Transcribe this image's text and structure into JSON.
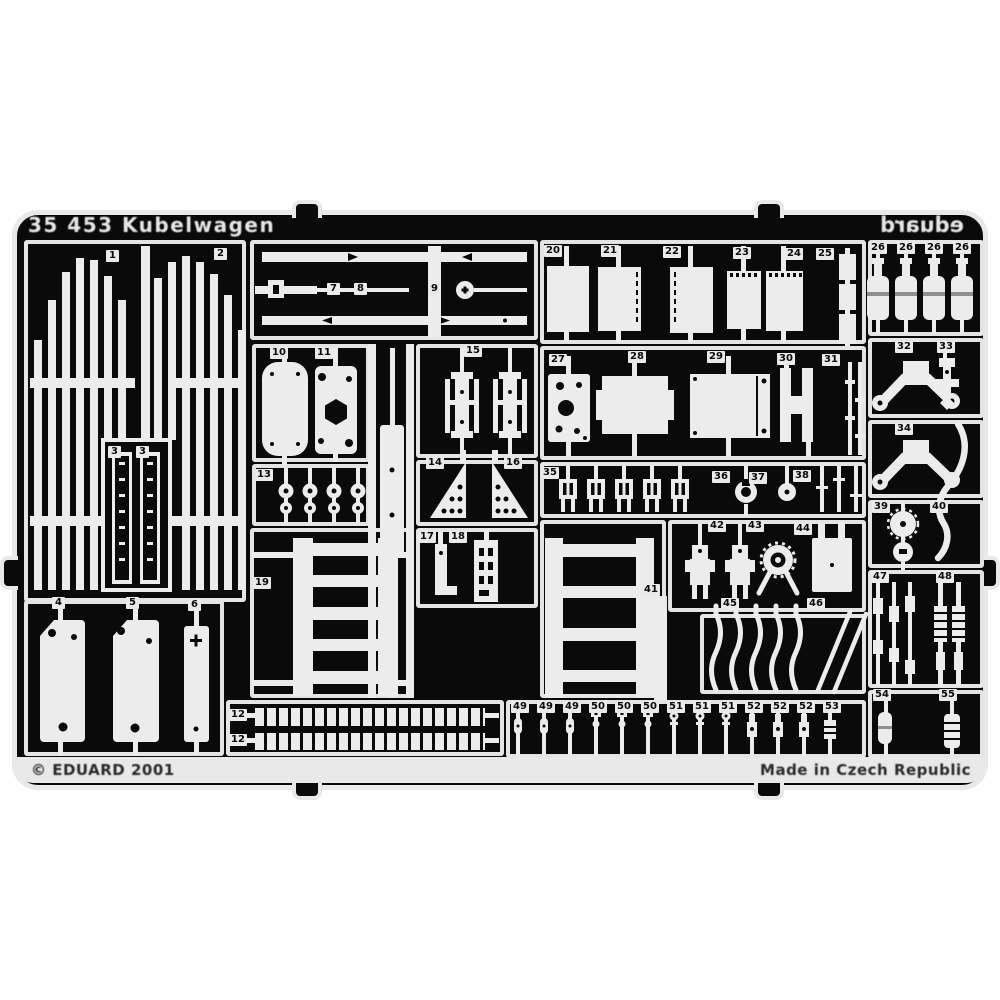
{
  "page": {
    "background": "#ffffff"
  },
  "fret": {
    "plate_color": "#0a0a0a",
    "metal_color": "#ececec",
    "set_title": "35 453 Kubelwagen",
    "brand_mirrored": "eduard",
    "copyright": "© EDUARD 2001",
    "made_in": "Made in Czech Republic",
    "part_labels": [
      {
        "n": "1",
        "x": 106,
        "y": 250
      },
      {
        "n": "2",
        "x": 214,
        "y": 248
      },
      {
        "n": "3",
        "x": 108,
        "y": 446
      },
      {
        "n": "3",
        "x": 136,
        "y": 446
      },
      {
        "n": "4",
        "x": 52,
        "y": 597
      },
      {
        "n": "5",
        "x": 126,
        "y": 597
      },
      {
        "n": "6",
        "x": 188,
        "y": 599
      },
      {
        "n": "7",
        "x": 327,
        "y": 283
      },
      {
        "n": "8",
        "x": 354,
        "y": 283
      },
      {
        "n": "9",
        "x": 428,
        "y": 283
      },
      {
        "n": "10",
        "x": 270,
        "y": 347
      },
      {
        "n": "11",
        "x": 315,
        "y": 347
      },
      {
        "n": "15",
        "x": 464,
        "y": 345
      },
      {
        "n": "14",
        "x": 426,
        "y": 457
      },
      {
        "n": "16",
        "x": 504,
        "y": 457
      },
      {
        "n": "13",
        "x": 255,
        "y": 469
      },
      {
        "n": "17",
        "x": 418,
        "y": 531
      },
      {
        "n": "18",
        "x": 449,
        "y": 531
      },
      {
        "n": "19",
        "x": 253,
        "y": 577
      },
      {
        "n": "12",
        "x": 229,
        "y": 709
      },
      {
        "n": "12",
        "x": 229,
        "y": 734
      },
      {
        "n": "20",
        "x": 544,
        "y": 245
      },
      {
        "n": "21",
        "x": 601,
        "y": 245
      },
      {
        "n": "22",
        "x": 663,
        "y": 246
      },
      {
        "n": "23",
        "x": 733,
        "y": 247
      },
      {
        "n": "24",
        "x": 785,
        "y": 248
      },
      {
        "n": "25",
        "x": 816,
        "y": 248
      },
      {
        "n": "26",
        "x": 869,
        "y": 242
      },
      {
        "n": "26",
        "x": 897,
        "y": 242
      },
      {
        "n": "26",
        "x": 925,
        "y": 242
      },
      {
        "n": "26",
        "x": 953,
        "y": 242
      },
      {
        "n": "27",
        "x": 549,
        "y": 354
      },
      {
        "n": "28",
        "x": 628,
        "y": 351
      },
      {
        "n": "29",
        "x": 707,
        "y": 351
      },
      {
        "n": "30",
        "x": 777,
        "y": 353
      },
      {
        "n": "31",
        "x": 822,
        "y": 354
      },
      {
        "n": "32",
        "x": 895,
        "y": 341
      },
      {
        "n": "33",
        "x": 937,
        "y": 341
      },
      {
        "n": "34",
        "x": 895,
        "y": 423
      },
      {
        "n": "35",
        "x": 541,
        "y": 467
      },
      {
        "n": "36",
        "x": 712,
        "y": 471
      },
      {
        "n": "37",
        "x": 749,
        "y": 472
      },
      {
        "n": "38",
        "x": 793,
        "y": 470
      },
      {
        "n": "39",
        "x": 872,
        "y": 501
      },
      {
        "n": "40",
        "x": 930,
        "y": 501
      },
      {
        "n": "41",
        "x": 642,
        "y": 584
      },
      {
        "n": "42",
        "x": 708,
        "y": 520
      },
      {
        "n": "43",
        "x": 746,
        "y": 520
      },
      {
        "n": "44",
        "x": 794,
        "y": 523
      },
      {
        "n": "45",
        "x": 721,
        "y": 598
      },
      {
        "n": "46",
        "x": 807,
        "y": 598
      },
      {
        "n": "47",
        "x": 871,
        "y": 571
      },
      {
        "n": "48",
        "x": 936,
        "y": 571
      },
      {
        "n": "49",
        "x": 511,
        "y": 701
      },
      {
        "n": "49",
        "x": 537,
        "y": 701
      },
      {
        "n": "49",
        "x": 563,
        "y": 701
      },
      {
        "n": "50",
        "x": 589,
        "y": 701
      },
      {
        "n": "50",
        "x": 615,
        "y": 701
      },
      {
        "n": "50",
        "x": 641,
        "y": 701
      },
      {
        "n": "51",
        "x": 667,
        "y": 701
      },
      {
        "n": "51",
        "x": 693,
        "y": 701
      },
      {
        "n": "51",
        "x": 719,
        "y": 701
      },
      {
        "n": "52",
        "x": 745,
        "y": 701
      },
      {
        "n": "52",
        "x": 771,
        "y": 701
      },
      {
        "n": "52",
        "x": 797,
        "y": 701
      },
      {
        "n": "53",
        "x": 823,
        "y": 701
      },
      {
        "n": "54",
        "x": 873,
        "y": 689
      },
      {
        "n": "55",
        "x": 939,
        "y": 689
      }
    ]
  }
}
